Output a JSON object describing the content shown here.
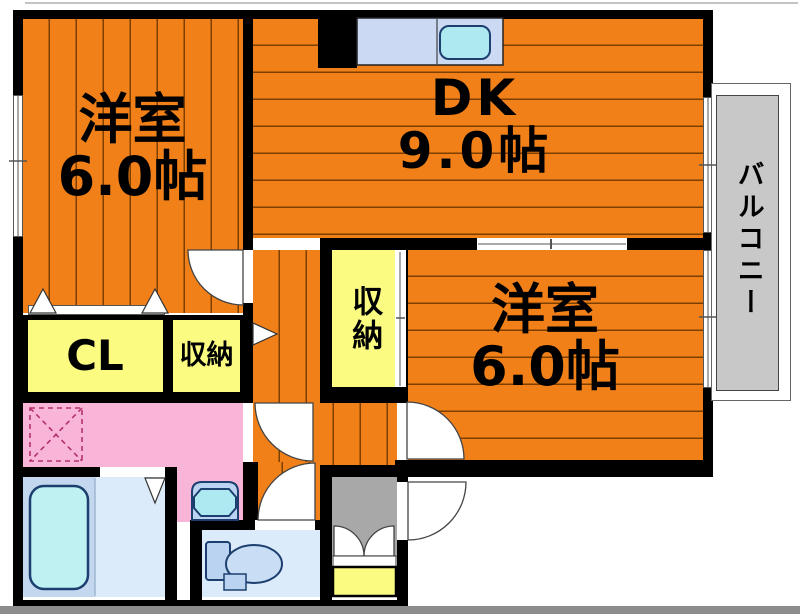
{
  "floorplan": {
    "title": "apartment-floor-plan",
    "rooms": {
      "western_room_1": {
        "name": "洋室",
        "size": "6.0帖"
      },
      "dining_kitchen": {
        "name": "DK",
        "size": "9.0帖"
      },
      "western_room_2": {
        "name": "洋室",
        "size": "6.0帖"
      },
      "closet": {
        "name": "CL"
      },
      "storage_hall": {
        "name": "収納"
      },
      "storage_mid": {
        "name": "収納"
      },
      "balcony": {
        "name": "バルコニー"
      }
    },
    "fixtures": [
      "kitchen-counter-sink",
      "bathtub",
      "washbasin",
      "toilet",
      "washing-machine-space",
      "shoe-cabinet"
    ],
    "colors": {
      "floor_orange": "#F28019",
      "stripe_brown": "#7c3f00",
      "closet_yellow": "#FBFB82",
      "washroom_pink": "#F9B5D8",
      "bath_blue": "#DCEBFA",
      "fixture_blue": "#B9D3F1",
      "water_cyan": "#AEE9F2",
      "counter_blue": "#CBD9F2",
      "genkan_gray": "#A8A8A8",
      "balcony_gray": "#C8C8C8",
      "wall_black": "#000000"
    }
  }
}
